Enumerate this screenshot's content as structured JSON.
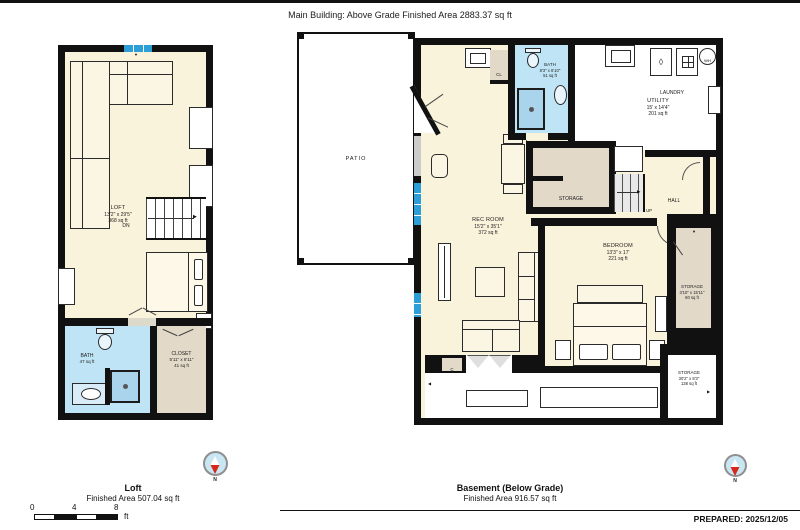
{
  "header": {
    "title": "Main Building: Above Grade Finished Area 2883.37 sq ft"
  },
  "loft_plan": {
    "rooms": {
      "loft": {
        "name": "LOFT",
        "dims": "13'2\" x 29'5\"",
        "area": "368 sq ft"
      },
      "bath": {
        "name": "BATH",
        "area": "47 sq ft"
      },
      "closet": {
        "name": "CLOSET",
        "dims": "5'11\" x 6'11\"",
        "area": "41 sq ft"
      }
    },
    "labels": {
      "dn": "DN"
    }
  },
  "basement_plan": {
    "rooms": {
      "patio": {
        "name": "PATIO"
      },
      "rec_room": {
        "name": "REC ROOM",
        "dims": "15'2\" x 35'1\"",
        "area": "372 sq ft"
      },
      "cl": {
        "name": "CL"
      },
      "bath": {
        "name": "BATH",
        "dims": "8'3\" x 6'10\"",
        "area": "51 sq ft"
      },
      "laundry": {
        "name": "LAUNDRY"
      },
      "wh": {
        "name": "WH"
      },
      "utility": {
        "name": "UTILITY",
        "dims": "15' x 14'4\"",
        "area": "201 sq ft"
      },
      "storage_mid": {
        "name": "STORAGE"
      },
      "hall": {
        "name": "HALL"
      },
      "up": "UP",
      "bedroom": {
        "name": "BEDROOM",
        "dims": "13'3\" x 17'",
        "area": "221 sq ft"
      },
      "storage_right": {
        "name": "STORAGE",
        "dims": "3'10\" x 15'11\"",
        "area": "60 sq ft"
      },
      "storage_bottom": {
        "name": "STORAGE",
        "dims": "30'2\" x 8'3\"",
        "area": "138 sq ft"
      },
      "c_closet": {
        "name": "C"
      }
    }
  },
  "footer": {
    "loft": {
      "title": "Loft",
      "area": "Finished Area 507.04 sq ft"
    },
    "basement": {
      "title": "Basement (Below Grade)",
      "area": "Finished Area 916.57 sq ft"
    },
    "prepared": "PREPARED: 2025/12/05",
    "scale": {
      "t0": "0",
      "t4": "4",
      "t8": "8",
      "unit": "ft"
    },
    "compass": {
      "label": "N"
    }
  },
  "icons": {
    "arrow_up": "▲",
    "arrow_down": "▼",
    "arrow_left": "◀",
    "arrow_right": "▶",
    "drop": "◊"
  },
  "colors": {
    "floor": "#FAF3DC",
    "wet": "#BFE4F5",
    "window": "#2D9FD8",
    "closet_tan": "#E3D9C9",
    "wall": "#111111",
    "compass_fill": "#C9E6F3",
    "needle_red": "#D6291E"
  }
}
